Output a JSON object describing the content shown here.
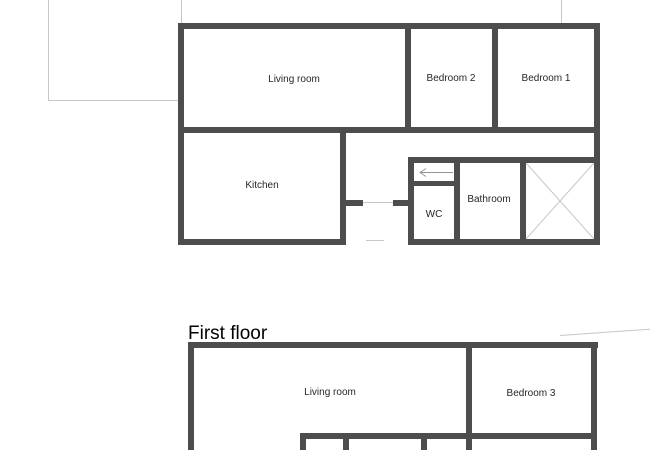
{
  "colors": {
    "wall": "#4d4d4d",
    "light_line": "#c6c6c6",
    "arrow": "#949494",
    "text": "#262626",
    "background": "#ffffff"
  },
  "ground_floor": {
    "rooms": [
      {
        "id": "living-room",
        "label": "Living room"
      },
      {
        "id": "bedroom-2",
        "label": "Bedroom 2"
      },
      {
        "id": "bedroom-1",
        "label": "Bedroom 1"
      },
      {
        "id": "kitchen",
        "label": "Kitchen"
      },
      {
        "id": "wc",
        "label": "WC"
      },
      {
        "id": "bathroom",
        "label": "Bathroom"
      }
    ],
    "icons": {
      "stairs_direction": "left-arrow",
      "stairwell_marker": "x-cross"
    }
  },
  "first_floor": {
    "title": "First floor",
    "rooms": [
      {
        "id": "living-room",
        "label": "Living room"
      },
      {
        "id": "bedroom-3",
        "label": "Bedroom 3"
      }
    ]
  }
}
